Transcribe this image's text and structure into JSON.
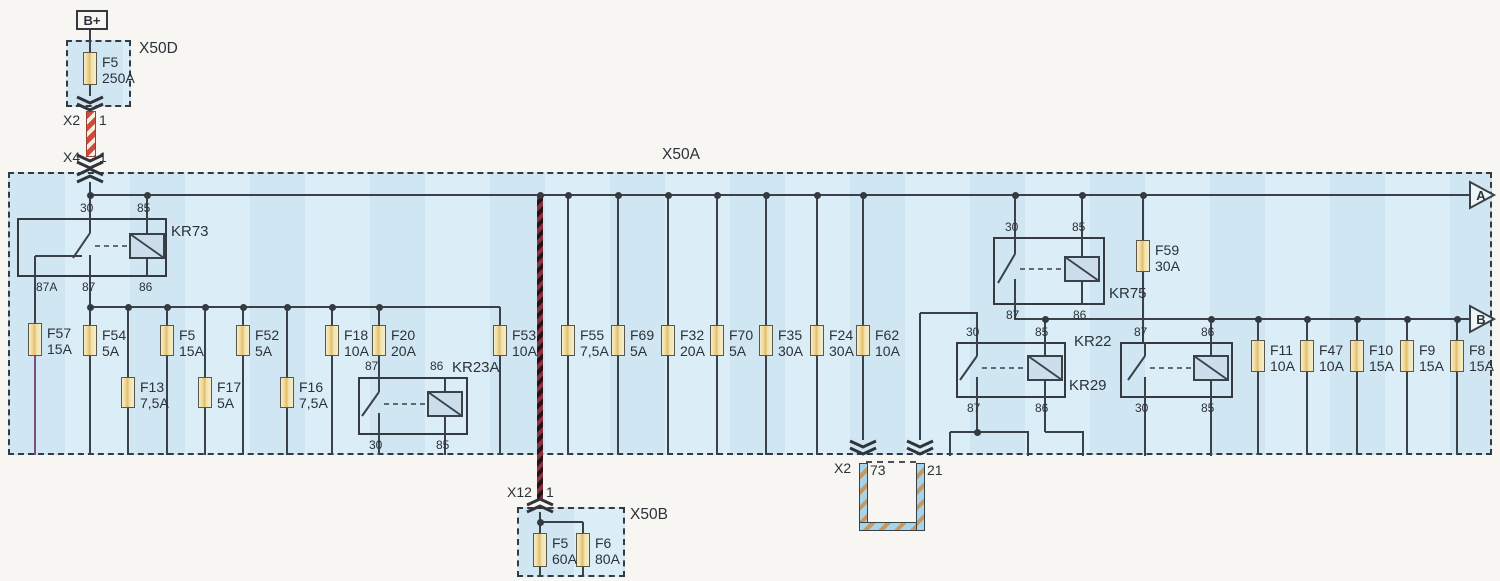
{
  "terminal": {
    "label": "B+",
    "box": [
      76,
      10,
      32,
      20
    ]
  },
  "boxes": [
    {
      "name": "x50d-box",
      "rect": [
        66,
        40,
        65,
        67
      ]
    },
    {
      "name": "x50a-box",
      "rect": [
        8,
        172,
        1484,
        283
      ]
    },
    {
      "name": "x50b-box",
      "rect": [
        517,
        507,
        108,
        70
      ]
    }
  ],
  "fuses": [
    {
      "name": "f5-250a",
      "label": "F5",
      "amps": "250A",
      "x": 90,
      "y": 52,
      "h": 33
    },
    {
      "name": "f57",
      "label": "F57",
      "amps": "15A",
      "x": 35,
      "y": 323,
      "h": 33
    },
    {
      "name": "f54",
      "label": "F54",
      "amps": "5A",
      "x": 90,
      "y": 325,
      "h": 31
    },
    {
      "name": "f13",
      "label": "F13",
      "amps": "7,5A",
      "x": 128,
      "y": 377,
      "h": 31
    },
    {
      "name": "f5",
      "label": "F5",
      "amps": "15A",
      "x": 167,
      "y": 325,
      "h": 31
    },
    {
      "name": "f17",
      "label": "F17",
      "amps": "5A",
      "x": 205,
      "y": 377,
      "h": 31
    },
    {
      "name": "f52",
      "label": "F52",
      "amps": "5A",
      "x": 243,
      "y": 325,
      "h": 31
    },
    {
      "name": "f16",
      "label": "F16",
      "amps": "7,5A",
      "x": 287,
      "y": 377,
      "h": 31
    },
    {
      "name": "f18",
      "label": "F18",
      "amps": "10A",
      "x": 332,
      "y": 325,
      "h": 31
    },
    {
      "name": "f20",
      "label": "F20",
      "amps": "20A",
      "x": 379,
      "y": 325,
      "h": 31
    },
    {
      "name": "f53",
      "label": "F53",
      "amps": "10A",
      "x": 500,
      "y": 325,
      "h": 31
    },
    {
      "name": "f55",
      "label": "F55",
      "amps": "7,5A",
      "x": 568,
      "y": 325,
      "h": 31
    },
    {
      "name": "f69",
      "label": "F69",
      "amps": "5A",
      "x": 618,
      "y": 325,
      "h": 31
    },
    {
      "name": "f32",
      "label": "F32",
      "amps": "20A",
      "x": 668,
      "y": 325,
      "h": 31
    },
    {
      "name": "f70",
      "label": "F70",
      "amps": "5A",
      "x": 717,
      "y": 325,
      "h": 31
    },
    {
      "name": "f35",
      "label": "F35",
      "amps": "30A",
      "x": 766,
      "y": 325,
      "h": 31
    },
    {
      "name": "f24",
      "label": "F24",
      "amps": "30A",
      "x": 817,
      "y": 325,
      "h": 31
    },
    {
      "name": "f62",
      "label": "F62",
      "amps": "10A",
      "x": 863,
      "y": 325,
      "h": 31
    },
    {
      "name": "f59",
      "label": "F59",
      "amps": "30A",
      "x": 1143,
      "y": 240,
      "h": 32
    },
    {
      "name": "f11",
      "label": "F11",
      "amps": "10A",
      "x": 1258,
      "y": 340,
      "h": 32
    },
    {
      "name": "f47",
      "label": "F47",
      "amps": "10A",
      "x": 1307,
      "y": 340,
      "h": 32
    },
    {
      "name": "f10",
      "label": "F10",
      "amps": "15A",
      "x": 1357,
      "y": 340,
      "h": 32
    },
    {
      "name": "f9",
      "label": "F9",
      "amps": "15A",
      "x": 1407,
      "y": 340,
      "h": 32
    },
    {
      "name": "f8",
      "label": "F8",
      "amps": "15A",
      "x": 1457,
      "y": 340,
      "h": 32
    },
    {
      "name": "f5-60a",
      "label": "F5",
      "amps": "60A",
      "x": 540,
      "y": 533,
      "h": 34
    },
    {
      "name": "f6-80a",
      "label": "F6",
      "amps": "80A",
      "x": 583,
      "y": 533,
      "h": 34
    }
  ],
  "relays": [
    {
      "name": "kr73",
      "label": "KR73",
      "label_pos": [
        171,
        224
      ],
      "box": [
        17,
        218,
        150,
        59
      ],
      "swx": 90,
      "coilx": 147,
      "pins": [
        {
          "label": "30",
          "pos": [
            80,
            202
          ]
        },
        {
          "label": "85",
          "pos": [
            137,
            202
          ]
        },
        {
          "label": "87A",
          "pos": [
            36,
            281
          ]
        },
        {
          "label": "87",
          "pos": [
            82,
            281
          ]
        },
        {
          "label": "86",
          "pos": [
            139,
            281
          ]
        }
      ]
    },
    {
      "name": "kr75",
      "label": "KR75",
      "label_pos": [
        1109,
        286
      ],
      "box": [
        993,
        237,
        112,
        68
      ],
      "swx": 1015,
      "coilx": 1082,
      "pins": [
        {
          "label": "30",
          "pos": [
            1005,
            221
          ]
        },
        {
          "label": "85",
          "pos": [
            1072,
            221
          ]
        },
        {
          "label": "87",
          "pos": [
            1006,
            309
          ]
        },
        {
          "label": "86",
          "pos": [
            1073,
            309
          ]
        }
      ]
    },
    {
      "name": "kr29",
      "label": "KR29",
      "label_pos": [
        1069,
        378
      ],
      "box": [
        956,
        342,
        110,
        56
      ],
      "swx": 977,
      "coilx": 1045,
      "pins": [
        {
          "label": "30",
          "pos": [
            966,
            326
          ]
        },
        {
          "label": "85",
          "pos": [
            1035,
            326
          ]
        },
        {
          "label": "87",
          "pos": [
            967,
            402
          ]
        },
        {
          "label": "86",
          "pos": [
            1035,
            402
          ]
        }
      ]
    },
    {
      "name": "kr22",
      "label": "KR22",
      "label_pos": [
        1074,
        334
      ],
      "box": [
        1120,
        342,
        113,
        56
      ],
      "swx": 1145,
      "coilx": 1211,
      "pins": [
        {
          "label": "87",
          "pos": [
            1134,
            326
          ]
        },
        {
          "label": "86",
          "pos": [
            1201,
            326
          ]
        },
        {
          "label": "30",
          "pos": [
            1135,
            402
          ]
        },
        {
          "label": "85",
          "pos": [
            1201,
            402
          ]
        }
      ]
    },
    {
      "name": "kr23a",
      "label": "KR23A",
      "label_pos": [
        452,
        360
      ],
      "box": [
        358,
        377,
        110,
        58
      ],
      "swx": 379,
      "coilx": 445,
      "pins": [
        {
          "label": "87",
          "pos": [
            365,
            360
          ]
        },
        {
          "label": "86",
          "pos": [
            430,
            360
          ]
        },
        {
          "label": "30",
          "pos": [
            369,
            439
          ]
        },
        {
          "label": "85",
          "pos": [
            436,
            439
          ]
        }
      ]
    }
  ],
  "labels": [
    {
      "name": "x50d-label",
      "text": "X50D",
      "x": 139,
      "y": 41,
      "cls": "big"
    },
    {
      "name": "x2-top-label",
      "text": "X2",
      "x": 63,
      "y": 113,
      "cls": "lbl"
    },
    {
      "name": "x2-top-pin",
      "text": "1",
      "x": 99,
      "y": 113,
      "cls": "lbl"
    },
    {
      "name": "x4-label",
      "text": "X4",
      "x": 63,
      "y": 150,
      "cls": "lbl"
    },
    {
      "name": "x4-pin",
      "text": "1",
      "x": 99,
      "y": 150,
      "cls": "lbl"
    },
    {
      "name": "x50a-label",
      "text": "X50A",
      "x": 662,
      "y": 147,
      "cls": "big"
    },
    {
      "name": "arrow-a-letter",
      "text": "A",
      "x": 1470,
      "y": 189,
      "cls": "arr"
    },
    {
      "name": "arrow-b-letter",
      "text": "B",
      "x": 1470,
      "y": 313,
      "cls": "arr"
    },
    {
      "name": "x2-bottom-label",
      "text": "X2",
      "x": 834,
      "y": 461,
      "cls": "lbl"
    },
    {
      "name": "x2-pin-73",
      "text": "73",
      "x": 870,
      "y": 463,
      "cls": "lbl"
    },
    {
      "name": "x2-pin-21",
      "text": "21",
      "x": 927,
      "y": 463,
      "cls": "lbl"
    },
    {
      "name": "x12-label",
      "text": "X12",
      "x": 507,
      "y": 485,
      "cls": "lbl"
    },
    {
      "name": "x12-pin",
      "text": "1",
      "x": 546,
      "y": 485,
      "cls": "lbl"
    },
    {
      "name": "x50b-label",
      "text": "X50B",
      "x": 630,
      "y": 507,
      "cls": "big"
    }
  ],
  "wires": [
    [
      90,
      30,
      90,
      52
    ],
    [
      90,
      85,
      90,
      96
    ],
    [
      90,
      111,
      90,
      155,
      "rs"
    ],
    [
      90,
      182,
      90,
      196
    ],
    [
      89,
      195,
      1471,
      195
    ],
    [
      90,
      195,
      90,
      218
    ],
    [
      147,
      195,
      147,
      218
    ],
    [
      35,
      256,
      35,
      277
    ],
    [
      35,
      256,
      82,
      256
    ],
    [
      35,
      277,
      35,
      323
    ],
    [
      35,
      356,
      35,
      455,
      "p"
    ],
    [
      90,
      277,
      90,
      307
    ],
    [
      90,
      307,
      500,
      307
    ],
    [
      90,
      307,
      90,
      325
    ],
    [
      90,
      356,
      90,
      455
    ],
    [
      128,
      307,
      128,
      377
    ],
    [
      128,
      408,
      128,
      455
    ],
    [
      167,
      307,
      167,
      325
    ],
    [
      167,
      356,
      167,
      455
    ],
    [
      205,
      307,
      205,
      377
    ],
    [
      205,
      408,
      205,
      455
    ],
    [
      243,
      307,
      243,
      325
    ],
    [
      243,
      356,
      243,
      455
    ],
    [
      287,
      307,
      287,
      377
    ],
    [
      287,
      408,
      287,
      455
    ],
    [
      332,
      307,
      332,
      325
    ],
    [
      332,
      356,
      332,
      455
    ],
    [
      379,
      307,
      379,
      325
    ],
    [
      379,
      356,
      379,
      377
    ],
    [
      500,
      307,
      500,
      325
    ],
    [
      500,
      356,
      500,
      455
    ],
    [
      379,
      435,
      379,
      455
    ],
    [
      445,
      435,
      445,
      455
    ],
    [
      568,
      195,
      568,
      325
    ],
    [
      568,
      356,
      568,
      455
    ],
    [
      618,
      195,
      618,
      325
    ],
    [
      618,
      356,
      618,
      455
    ],
    [
      668,
      195,
      668,
      325
    ],
    [
      668,
      356,
      668,
      455
    ],
    [
      717,
      195,
      717,
      325
    ],
    [
      717,
      356,
      717,
      455
    ],
    [
      766,
      195,
      766,
      325
    ],
    [
      766,
      356,
      766,
      455
    ],
    [
      817,
      195,
      817,
      325
    ],
    [
      817,
      356,
      817,
      455
    ],
    [
      863,
      195,
      863,
      325
    ],
    [
      863,
      356,
      863,
      440
    ],
    [
      540,
      195,
      540,
      500,
      "ds"
    ],
    [
      1015,
      195,
      1015,
      237
    ],
    [
      1082,
      195,
      1082,
      237
    ],
    [
      1015,
      305,
      1015,
      320
    ],
    [
      1015,
      319,
      1471,
      319
    ],
    [
      1143,
      195,
      1143,
      240
    ],
    [
      1143,
      272,
      1143,
      342
    ],
    [
      920,
      313,
      978,
      313
    ],
    [
      977,
      313,
      977,
      342
    ],
    [
      920,
      313,
      920,
      440
    ],
    [
      1045,
      319,
      1045,
      342
    ],
    [
      977,
      398,
      977,
      432
    ],
    [
      950,
      432,
      1029,
      432
    ],
    [
      950,
      432,
      950,
      456
    ],
    [
      1028,
      432,
      1028,
      456
    ],
    [
      1045,
      398,
      1045,
      432
    ],
    [
      1045,
      432,
      1084,
      432
    ],
    [
      1083,
      432,
      1083,
      456
    ],
    [
      1145,
      398,
      1145,
      456
    ],
    [
      1211,
      398,
      1211,
      456
    ],
    [
      1211,
      319,
      1211,
      342
    ],
    [
      1258,
      319,
      1258,
      340
    ],
    [
      1258,
      372,
      1258,
      455
    ],
    [
      1307,
      319,
      1307,
      340
    ],
    [
      1307,
      372,
      1307,
      455
    ],
    [
      1357,
      319,
      1357,
      340
    ],
    [
      1357,
      372,
      1357,
      455
    ],
    [
      1407,
      319,
      1407,
      340
    ],
    [
      1407,
      372,
      1407,
      455
    ],
    [
      1457,
      319,
      1457,
      340
    ],
    [
      1457,
      372,
      1457,
      455
    ],
    [
      540,
      512,
      540,
      533
    ],
    [
      540,
      522,
      583,
      522
    ],
    [
      583,
      522,
      583,
      533
    ],
    [
      540,
      567,
      540,
      577
    ],
    [
      583,
      567,
      583,
      577
    ]
  ],
  "uloop": {
    "x1": 863,
    "x2": 920,
    "y1": 463,
    "y2": 531,
    "w": 9
  },
  "dash_tick": {
    "x": 866,
    "y": 461,
    "w": 50
  },
  "dots": [
    [
      90,
      195
    ],
    [
      147,
      195
    ],
    [
      540,
      195
    ],
    [
      568,
      195
    ],
    [
      618,
      195
    ],
    [
      668,
      195
    ],
    [
      717,
      195
    ],
    [
      766,
      195
    ],
    [
      817,
      195
    ],
    [
      863,
      195
    ],
    [
      1015,
      195
    ],
    [
      1082,
      195
    ],
    [
      1143,
      195
    ],
    [
      90,
      307
    ],
    [
      128,
      307
    ],
    [
      167,
      307
    ],
    [
      205,
      307
    ],
    [
      243,
      307
    ],
    [
      287,
      307
    ],
    [
      332,
      307
    ],
    [
      379,
      307
    ],
    [
      1045,
      319
    ],
    [
      1211,
      319
    ],
    [
      1258,
      319
    ],
    [
      1307,
      319
    ],
    [
      1357,
      319
    ],
    [
      1407,
      319
    ],
    [
      1457,
      319
    ],
    [
      977,
      432
    ],
    [
      540,
      522
    ]
  ],
  "chevrons": [
    {
      "x": 90,
      "y": 97,
      "dir": "down",
      "name": "connector-x2-top"
    },
    {
      "x": 90,
      "y": 155,
      "dir": "down",
      "name": "connector-x4-out"
    },
    {
      "x": 90,
      "y": 169,
      "dir": "up",
      "name": "connector-x4-in"
    },
    {
      "x": 863,
      "y": 441,
      "dir": "down",
      "name": "connector-x2-73"
    },
    {
      "x": 920,
      "y": 441,
      "dir": "down",
      "name": "connector-x2-21"
    },
    {
      "x": 540,
      "y": 499,
      "dir": "up",
      "name": "connector-x12"
    }
  ],
  "arrows": [
    {
      "name": "bus-arrow-a",
      "x": 1470,
      "cy": 195
    },
    {
      "name": "bus-arrow-b",
      "x": 1470,
      "cy": 319
    }
  ],
  "colors": {
    "line": "#3b4148",
    "box_fill": "#d9ecf6",
    "fuse_fill": "#f2e2a8",
    "stripe_red": "#cf4a3a",
    "stripe_dark": "#8c3040",
    "loop_blue": "#a9d3e8",
    "loop_brown": "#c49a62",
    "wire_purple": "#7a4e78",
    "coil_fill": "#ccddeb"
  }
}
